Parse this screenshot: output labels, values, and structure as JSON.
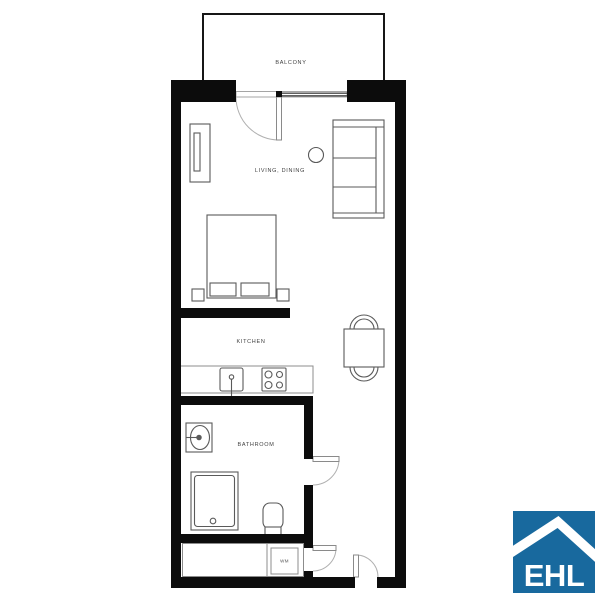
{
  "floor_plan": {
    "labels": {
      "balcony": "BALCONY",
      "living_dining": "LIVING, DINING",
      "kitchen": "KITCHEN",
      "bathroom": "BATHROOM",
      "washing_machine": "WM"
    },
    "fixtures": [
      "balcony-terrace",
      "balcony-door",
      "window",
      "sideboard-cabinet",
      "wardrobe-shelf",
      "pendant-lamp",
      "double-bed",
      "pillows",
      "nightstand-left",
      "nightstand-right",
      "kitchen-counter",
      "kitchen-sink",
      "stove-four-burners",
      "dining-table",
      "dining-chair-top",
      "dining-chair-bottom",
      "bathroom-sink",
      "shower",
      "toilet",
      "closet",
      "washing-machine",
      "bathroom-door",
      "closet-door",
      "entrance-door"
    ],
    "colors": {
      "wall": "#0c0c0c",
      "furniture_line": "#5a5a5a",
      "light_line": "#8c8c8c",
      "door_arc": "#b0b0b0",
      "window_line": "#4a4a4a",
      "label_text": "#3f3f3f",
      "background": "#ffffff"
    }
  },
  "logo": {
    "text": "EHL",
    "icon": "house-roof-icon",
    "background_color": "#18699E",
    "text_color": "#ffffff"
  }
}
